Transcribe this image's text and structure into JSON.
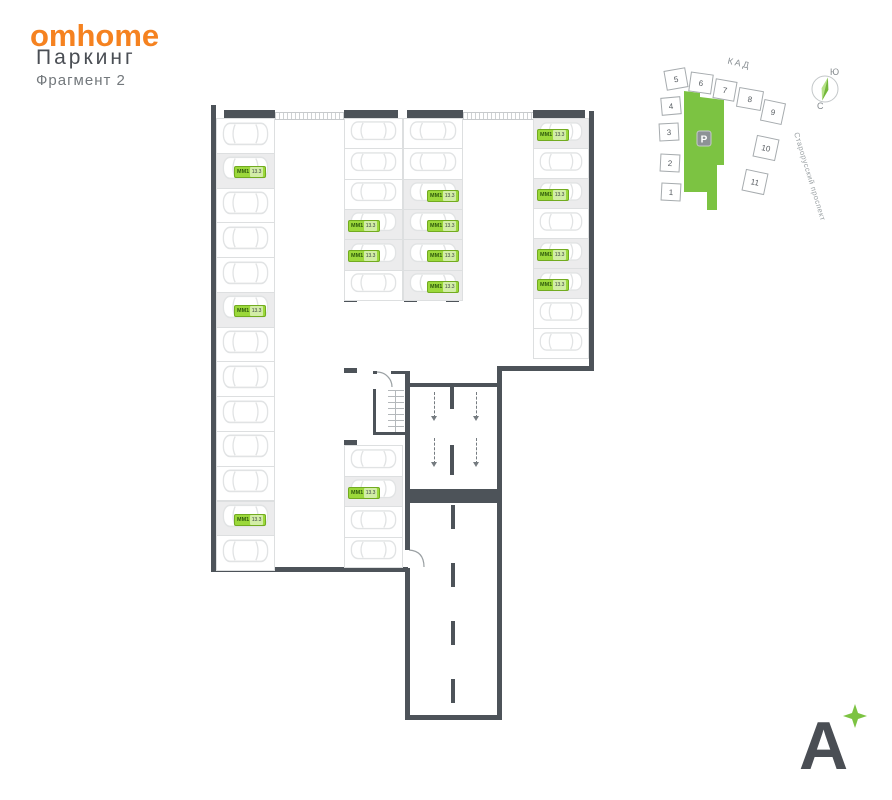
{
  "header": {
    "brand": "omhome",
    "title": "Паркинг",
    "subtitle": "Фрагмент 2"
  },
  "sitemap": {
    "road_label": "КАД",
    "street_label": "Старорусский проспект",
    "parking_badge": "P",
    "compass": {
      "top": "Ю",
      "bottom": "С"
    },
    "buildings": [
      "1",
      "2",
      "3",
      "4",
      "5",
      "6",
      "7",
      "8",
      "9",
      "10",
      "11"
    ]
  },
  "plan": {
    "badge_code": "ММ1",
    "badge_area": "13.3",
    "groups": [
      {
        "id": "left-column",
        "spots": [
          {},
          {
            "badge": true
          },
          {},
          {},
          {},
          {
            "badge": true
          },
          {},
          {},
          {},
          {},
          {},
          {
            "badge": true
          },
          {}
        ]
      },
      {
        "id": "middle-left-column",
        "spots": [
          {},
          {},
          {},
          {
            "badge": true
          },
          {
            "badge": true
          },
          {}
        ]
      },
      {
        "id": "middle-right-column",
        "spots": [
          {},
          {},
          {
            "badge": true
          },
          {
            "badge": true
          },
          {
            "badge": true
          },
          {
            "badge": true
          }
        ]
      },
      {
        "id": "right-column",
        "spots": [
          {
            "badge": true
          },
          {},
          {
            "badge": true
          },
          {},
          {
            "badge": true
          },
          {
            "badge": true
          },
          {},
          {}
        ]
      },
      {
        "id": "bottom-middle-column",
        "spots": [
          {},
          {
            "badge": true
          },
          {},
          {}
        ]
      }
    ]
  },
  "footer": {
    "logo_letter": "A"
  },
  "colors": {
    "brand_orange": "#F58220",
    "wall": "#4D5359",
    "badge_green": "#9BD83A",
    "map_green": "#7CC342"
  }
}
